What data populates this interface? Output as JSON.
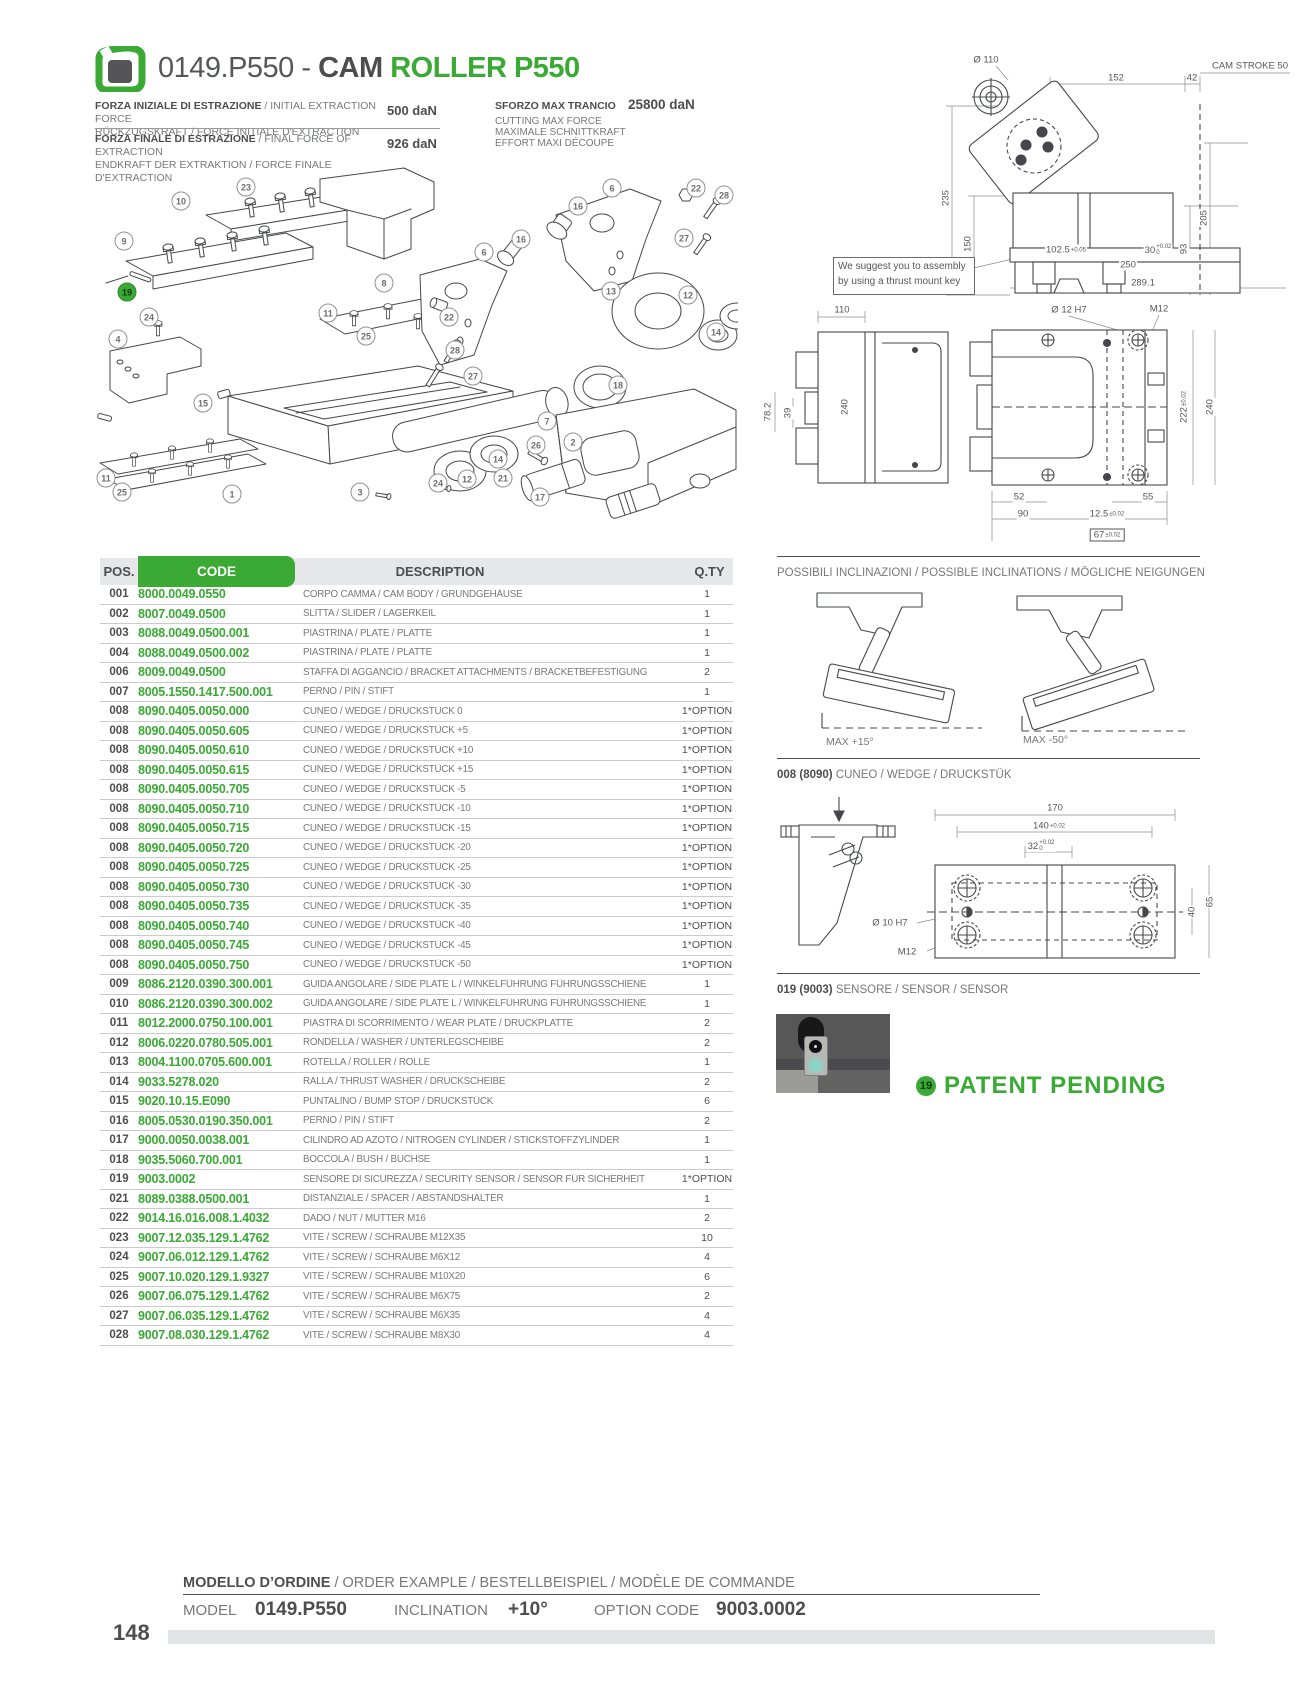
{
  "page": {
    "number": "148"
  },
  "header": {
    "title_code": "0149.P550 - ",
    "title_cam": "CAM ",
    "title_roller": "ROLLER P550",
    "specs": [
      {
        "line1_bold": "FORZA INIZIALE DI ESTRAZIONE",
        "line1_rest": " / INITIAL EXTRACTION FORCE",
        "line2": "RÜCKZUGSKRAFT / FORCE INITIALE D'EXTRACTION",
        "value": "500 daN"
      },
      {
        "line1_bold": "FORZA FINALE DI ESTRAZIONE",
        "line1_rest": " / FINAL FORCE OF EXTRACTION",
        "line2": "ENDKRAFT DER EXTRAKTION / FORCE FINALE D'EXTRACTION",
        "value": "926 daN"
      }
    ],
    "max_cut": {
      "title": "SFORZO MAX TRANCIO",
      "value": "25800 daN",
      "lines": [
        "CUTTING MAX FORCE",
        "MAXIMALE SCHNITTKRAFT",
        "EFFORT MAXI DÉCOUPE"
      ]
    }
  },
  "exploded_view": {
    "callouts": [
      {
        "n": "10",
        "x": 93,
        "y": 38
      },
      {
        "n": "23",
        "x": 158,
        "y": 24
      },
      {
        "n": "9",
        "x": 36,
        "y": 78
      },
      {
        "n": "19",
        "x": 39,
        "y": 129,
        "green": 1
      },
      {
        "n": "24",
        "x": 61,
        "y": 154
      },
      {
        "n": "4",
        "x": 30,
        "y": 176
      },
      {
        "n": "15",
        "x": 115,
        "y": 240
      },
      {
        "n": "11",
        "x": 240,
        "y": 150
      },
      {
        "n": "25",
        "x": 278,
        "y": 173
      },
      {
        "n": "11",
        "x": 18,
        "y": 315
      },
      {
        "n": "25",
        "x": 34,
        "y": 329
      },
      {
        "n": "1",
        "x": 144,
        "y": 331
      },
      {
        "n": "8",
        "x": 296,
        "y": 120
      },
      {
        "n": "22",
        "x": 361,
        "y": 154
      },
      {
        "n": "6",
        "x": 396,
        "y": 89
      },
      {
        "n": "16",
        "x": 433,
        "y": 76
      },
      {
        "n": "28",
        "x": 367,
        "y": 187
      },
      {
        "n": "27",
        "x": 385,
        "y": 213
      },
      {
        "n": "16",
        "x": 490,
        "y": 43
      },
      {
        "n": "6",
        "x": 524,
        "y": 25
      },
      {
        "n": "22",
        "x": 608,
        "y": 25
      },
      {
        "n": "28",
        "x": 636,
        "y": 32
      },
      {
        "n": "27",
        "x": 596,
        "y": 75
      },
      {
        "n": "13",
        "x": 523,
        "y": 128
      },
      {
        "n": "12",
        "x": 600,
        "y": 132
      },
      {
        "n": "14",
        "x": 628,
        "y": 169
      },
      {
        "n": "18",
        "x": 530,
        "y": 222
      },
      {
        "n": "7",
        "x": 459,
        "y": 258
      },
      {
        "n": "14",
        "x": 410,
        "y": 296
      },
      {
        "n": "12",
        "x": 379,
        "y": 316
      },
      {
        "n": "24",
        "x": 350,
        "y": 320
      },
      {
        "n": "26",
        "x": 448,
        "y": 282
      },
      {
        "n": "2",
        "x": 485,
        "y": 279
      },
      {
        "n": "3",
        "x": 272,
        "y": 329
      },
      {
        "n": "21",
        "x": 415,
        "y": 315
      },
      {
        "n": "17",
        "x": 452,
        "y": 334
      }
    ]
  },
  "drawings": {
    "note": [
      "We suggest you to assembly",
      "by using a thrust mount key"
    ],
    "side_view_labels": [
      {
        "t": "Ø 110",
        "x": 48,
        "y": 12
      },
      {
        "t": "152",
        "x": 178,
        "y": 30
      },
      {
        "t": "42",
        "x": 254,
        "y": 30
      },
      {
        "t": "CAM STROKE 50",
        "x": 312,
        "y": 18
      },
      {
        "t": "235",
        "x": 8,
        "y": 150,
        "r": 1
      },
      {
        "t": "150",
        "x": 30,
        "y": 196,
        "r": 1
      },
      {
        "t": "205",
        "x": 266,
        "y": 170,
        "r": 1
      },
      {
        "t": "93",
        "x": 246,
        "y": 201,
        "r": 1
      },
      {
        "t": "102.5|+0.05",
        "x": 128,
        "y": 202
      },
      {
        "t": "30|+0.02|0",
        "x": 220,
        "y": 202
      },
      {
        "t": "250",
        "x": 190,
        "y": 217
      },
      {
        "t": "289.1",
        "x": 205,
        "y": 235
      }
    ],
    "front_view_labels": [
      {
        "t": "110",
        "x": 87,
        "y": 15
      },
      {
        "t": "78.2",
        "x": 13,
        "y": 117,
        "r": 1
      },
      {
        "t": "39",
        "x": 33,
        "y": 118,
        "r": 1
      },
      {
        "t": "240",
        "x": 90,
        "y": 112,
        "r": 1
      },
      {
        "t": "Ø 12 H7",
        "x": 314,
        "y": 15
      },
      {
        "t": "M12",
        "x": 404,
        "y": 14
      },
      {
        "t": "222|±0.02",
        "x": 429,
        "y": 112,
        "r": 1
      },
      {
        "t": "240",
        "x": 455,
        "y": 112,
        "r": 1
      },
      {
        "t": "52",
        "x": 264,
        "y": 202
      },
      {
        "t": "90",
        "x": 268,
        "y": 219
      },
      {
        "t": "12.5|±0.02",
        "x": 352,
        "y": 219
      },
      {
        "t": "55",
        "x": 393,
        "y": 202
      },
      {
        "t": "67|±0.02",
        "x": 352,
        "y": 240,
        "box": 1
      }
    ],
    "wedge_labels": [
      {
        "t": "170",
        "x": 278,
        "y": 13
      },
      {
        "t": "140|+0.02",
        "x": 272,
        "y": 31
      },
      {
        "t": "32|+0.02|0",
        "x": 264,
        "y": 51
      },
      {
        "t": "Ø 10 H7",
        "x": 113,
        "y": 128
      },
      {
        "t": "M12",
        "x": 130,
        "y": 157
      },
      {
        "t": "40",
        "x": 415,
        "y": 117,
        "r": 1
      },
      {
        "t": "65",
        "x": 433,
        "y": 107,
        "r": 1
      }
    ]
  },
  "inclinations": {
    "heading": "POSSIBILI INCLINAZIONI / POSSIBLE INCLINATIONS / MÖGLICHE NEIGUNGEN",
    "max_pos": "MAX +15°",
    "max_neg": "MAX -50°"
  },
  "wedge": {
    "heading_bold": "008 (8090)",
    "heading_rest": " CUNEO / WEDGE / DRUCKSTÜK"
  },
  "sensor": {
    "heading_bold": "019 (9003)",
    "heading_rest": " SENSORE / SENSOR / SENSOR",
    "badge": "19",
    "patent": "PATENT PENDING"
  },
  "parts_table": {
    "headers": {
      "pos": "POS.",
      "code": "CODE",
      "description": "DESCRIPTION",
      "qty": "Q.TY"
    },
    "rows": [
      [
        "001",
        "8000.0049.0550",
        "CORPO CAMMA / CAM BODY / GRUNDGEHÄUSE",
        "1"
      ],
      [
        "002",
        "8007.0049.0500",
        "SLITTA / SLIDER / LAGERKEIL",
        "1"
      ],
      [
        "003",
        "8088.0049.0500.001",
        "PIASTRINA / PLATE / PLATTE",
        "1"
      ],
      [
        "004",
        "8088.0049.0500.002",
        "PIASTRINA / PLATE / PLATTE",
        "1"
      ],
      [
        "006",
        "8009.0049.0500",
        "STAFFA DI AGGANCIO / BRACKET ATTACHMENTS / BRACKETBEFESTIGUNG",
        "2"
      ],
      [
        "007",
        "8005.1550.1417.500.001",
        "PERNO / PIN / STIFT",
        "1"
      ],
      [
        "008",
        "8090.0405.0050.000",
        "CUNEO / WEDGE / DRUCKSTÜCK 0",
        "1*OPTION"
      ],
      [
        "008",
        "8090.0405.0050.605",
        "CUNEO / WEDGE / DRUCKSTÜCK +5",
        "1*OPTION"
      ],
      [
        "008",
        "8090.0405.0050.610",
        "CUNEO / WEDGE / DRUCKSTÜCK +10",
        "1*OPTION"
      ],
      [
        "008",
        "8090.0405.0050.615",
        "CUNEO / WEDGE / DRUCKSTÜCK +15",
        "1*OPTION"
      ],
      [
        "008",
        "8090.0405.0050.705",
        "CUNEO / WEDGE / DRUCKSTÜCK -5",
        "1*OPTION"
      ],
      [
        "008",
        "8090.0405.0050.710",
        "CUNEO / WEDGE / DRUCKSTÜCK -10",
        "1*OPTION"
      ],
      [
        "008",
        "8090.0405.0050.715",
        "CUNEO / WEDGE / DRUCKSTÜCK -15",
        "1*OPTION"
      ],
      [
        "008",
        "8090.0405.0050.720",
        "CUNEO / WEDGE / DRUCKSTÜCK -20",
        "1*OPTION"
      ],
      [
        "008",
        "8090.0405.0050.725",
        "CUNEO / WEDGE / DRUCKSTÜCK -25",
        "1*OPTION"
      ],
      [
        "008",
        "8090.0405.0050.730",
        "CUNEO / WEDGE / DRUCKSTÜCK -30",
        "1*OPTION"
      ],
      [
        "008",
        "8090.0405.0050.735",
        "CUNEO / WEDGE / DRUCKSTÜCK -35",
        "1*OPTION"
      ],
      [
        "008",
        "8090.0405.0050.740",
        "CUNEO / WEDGE / DRUCKSTÜCK -40",
        "1*OPTION"
      ],
      [
        "008",
        "8090.0405.0050.745",
        "CUNEO / WEDGE / DRUCKSTÜCK -45",
        "1*OPTION"
      ],
      [
        "008",
        "8090.0405.0050.750",
        "CUNEO / WEDGE / DRUCKSTÜCK -50",
        "1*OPTION"
      ],
      [
        "009",
        "8086.2120.0390.300.001",
        "GUIDA ANGOLARE / SIDE PLATE L / WINKELFÜHRUNG FÜHRUNGSSCHIENE",
        "1"
      ],
      [
        "010",
        "8086.2120.0390.300.002",
        "GUIDA ANGOLARE / SIDE PLATE L / WINKELFÜHRUNG FÜHRUNGSSCHIENE",
        "1"
      ],
      [
        "011",
        "8012.2000.0750.100.001",
        "PIASTRA DI SCORRIMENTO / WEAR PLATE / DRUCKPLATTE",
        "2"
      ],
      [
        "012",
        "8006.0220.0780.505.001",
        "RONDELLA / WASHER / UNTERLEGSCHEIBE",
        "2"
      ],
      [
        "013",
        "8004.1100.0705.600.001",
        "ROTELLA / ROLLER / ROLLE",
        "1"
      ],
      [
        "014",
        "9033.5278.020",
        "RALLA / THRUST WASHER / DRUCKSCHEIBE",
        "2"
      ],
      [
        "015",
        "9020.10.15.E090",
        "PUNTALINO / BUMP STOP / DRUCKSTÜCK",
        "6"
      ],
      [
        "016",
        "8005.0530.0190.350.001",
        "PERNO / PIN / STIFT",
        "2"
      ],
      [
        "017",
        "9000.0050.0038.001",
        "CILINDRO AD AZOTO / NITROGEN CYLINDER / STICKSTOFFZYLINDER",
        "1"
      ],
      [
        "018",
        "9035.5060.700.001",
        "BOCCOLA / BUSH / BUCHSE",
        "1"
      ],
      [
        "019",
        "9003.0002",
        "SENSORE DI SICUREZZA / SECURITY SENSOR / SENSOR FÜR SICHERHEIT",
        "1*OPTION"
      ],
      [
        "021",
        "8089.0388.0500.001",
        "DISTANZIALE / SPACER / ABSTANDSHALTER",
        "1"
      ],
      [
        "022",
        "9014.16.016.008.1.4032",
        "DADO / NUT / MUTTER M16",
        "2"
      ],
      [
        "023",
        "9007.12.035.129.1.4762",
        "VITE / SCREW / SCHRAUBE M12X35",
        "10"
      ],
      [
        "024",
        "9007.06.012.129.1.4762",
        "VITE / SCREW / SCHRAUBE M6X12",
        "4"
      ],
      [
        "025",
        "9007.10.020.129.1.9327",
        "VITE / SCREW / SCHRAUBE M10X20",
        "6"
      ],
      [
        "026",
        "9007.06.075.129.1.4762",
        "VITE / SCREW / SCHRAUBE M6X75",
        "2"
      ],
      [
        "027",
        "9007.06.035.129.1.4762",
        "VITE / SCREW / SCHRAUBE M6X35",
        "4"
      ],
      [
        "028",
        "9007.08.030.129.1.4762",
        "VITE / SCREW / SCHRAUBE M8X30",
        "4"
      ]
    ]
  },
  "order_example": {
    "heading_bold": "MODELLO D’ORDINE",
    "heading_rest": " / ORDER EXAMPLE / BESTELLBEISPIEL / MODÈLE DE COMMANDE",
    "model_label": "MODEL",
    "model_value": "0149.P550",
    "inclination_label": "INCLINATION",
    "inclination_value": "+10°",
    "option_label": "OPTION CODE",
    "option_value": "9003.0002"
  }
}
